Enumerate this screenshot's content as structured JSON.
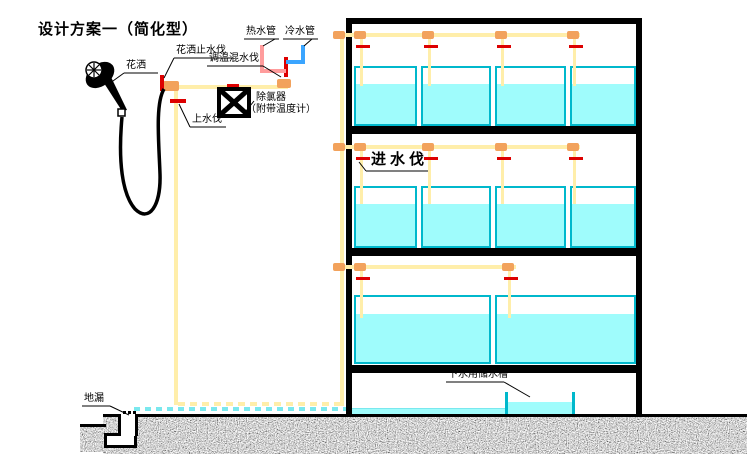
{
  "title": "设计方案一（简化型）",
  "labels": {
    "shower_head": "花洒",
    "shower_stop_valve": "花洒止水伐",
    "mixing_valve": "调温混水伐",
    "hot_water_pipe": "热水管",
    "cold_water_pipe": "冷水管",
    "dechlorinator": "除氯器",
    "dechlorinator_note": "（附带温度计）",
    "supply_valve": "上水伐",
    "inlet_valve": "进水伐",
    "drain_storage_tank": "下水用储水槽",
    "floor_drain": "地漏"
  },
  "rack": {
    "shelf_count": 3,
    "tanks_per_shelf": [
      4,
      4,
      2
    ],
    "inlet_valves_per_shelf": [
      4,
      4,
      2
    ],
    "bottom_compartment": "storage"
  },
  "colors": {
    "background": "#ffffff",
    "pipe": "#ffeeaa",
    "connector": "#f2a25c",
    "valve": "#dd0000",
    "hot": "#ff9c9c",
    "cold": "#3aa5ff",
    "tank_border": "#00b8cc",
    "water": "#9ffcfc",
    "frame": "#000000"
  }
}
